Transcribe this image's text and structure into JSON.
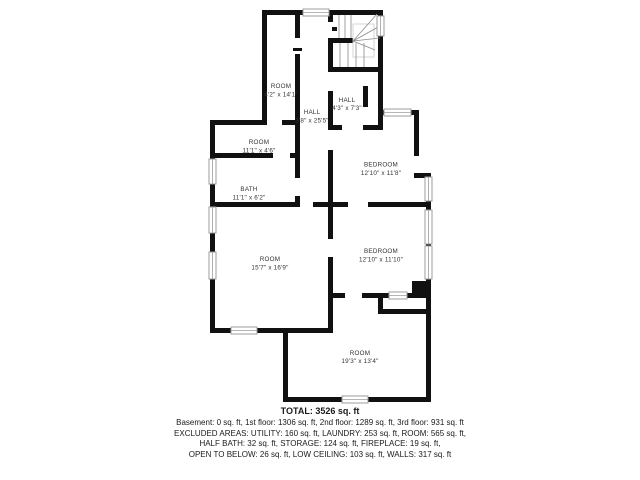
{
  "colors": {
    "wall": "#111111",
    "window_stroke": "#9c9c9c",
    "stair_detail": "#8a8a8a",
    "label_text": "#333333",
    "summary_text": "#1a1a1a",
    "background": "#ffffff"
  },
  "floorplan": {
    "rooms": [
      {
        "label": "ROOM",
        "dims": "4'2\" x 14'1\""
      },
      {
        "label": "HALL",
        "dims": "3'8\" x 25'5\""
      },
      {
        "label": "HALL",
        "dims": "4'3\" x 7'3\""
      },
      {
        "label": "ROOM",
        "dims": "11'1\" x 4'6\""
      },
      {
        "label": "BATH",
        "dims": "11'1\" x 6'2\""
      },
      {
        "label": "BEDROOM",
        "dims": "12'10\" x 11'8\""
      },
      {
        "label": "ROOM",
        "dims": "15'7\" x 16'9\""
      },
      {
        "label": "BEDROOM",
        "dims": "12'10\" x 11'10\""
      },
      {
        "label": "ROOM",
        "dims": "19'3\" x 13'4\""
      }
    ]
  },
  "summary": {
    "total": "TOTAL: 3526 sq. ft",
    "lines": [
      "Basement: 0 sq. ft, 1st floor: 1306 sq. ft, 2nd floor: 1289 sq. ft, 3rd floor: 931 sq. ft",
      "EXCLUDED AREAS: UTILITY: 160 sq. ft, LAUNDRY: 253 sq. ft, ROOM: 565 sq. ft,",
      "HALF BATH: 32 sq. ft, STORAGE: 124 sq. ft, FIREPLACE: 19 sq. ft,",
      "OPEN TO BELOW: 26 sq. ft, LOW CEILING: 103 sq. ft, WALLS: 317 sq. ft"
    ]
  }
}
